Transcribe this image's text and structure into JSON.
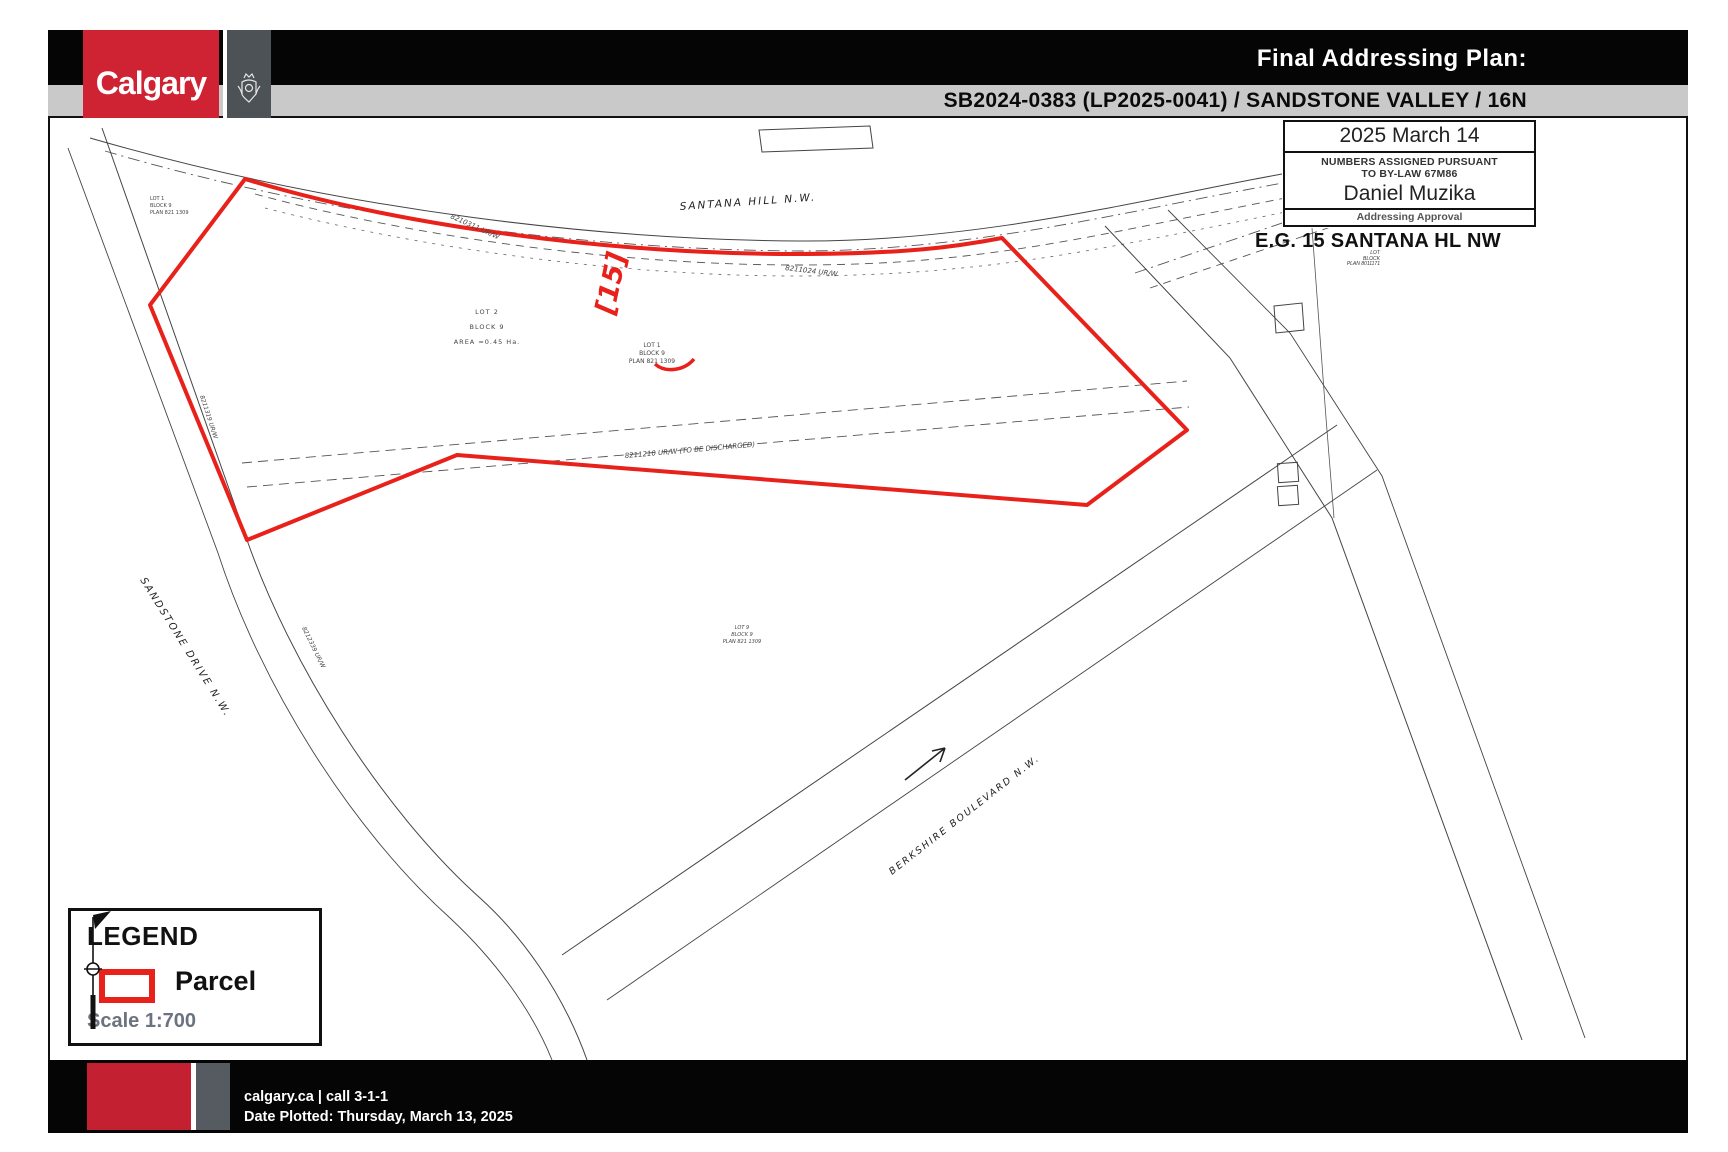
{
  "header": {
    "logo_text": "Calgary",
    "title": "Final Addressing Plan:",
    "subtitle": "SB2024-0383 (LP2025-0041) / SANDSTONE VALLEY / 16N"
  },
  "approval": {
    "date": "2025 March 14",
    "notice_line1": "NUMBERS ASSIGNED PURSUANT",
    "notice_line2": "TO BY-LAW 67M86",
    "approver": "Daniel Muzika",
    "caption": "Addressing Approval"
  },
  "map": {
    "address_note": "E.G. 15 SANTANA HL NW",
    "parcel_tag": "[15]",
    "street_labels": {
      "santana": "SANTANA HILL N.W.",
      "sandstone": "SANDSTONE DRIVE N.W.",
      "berkshire": "BERKSHIRE BOULEVARD N.W."
    },
    "easement_labels": {
      "top_left": "8210311 UR/W",
      "top_right": "8211024 UR/W",
      "middle": "8211210 UR/W (TO BE DISCHARGED)",
      "west_upper": "8211319 UR/W",
      "west_lower": "8212339 UR/W"
    },
    "lot_labels": {
      "northwest_corner": [
        "LOT 1",
        "BLOCK 9",
        "PLAN 821 1309"
      ],
      "lot2": [
        "LOT 2",
        "BLOCK 9",
        "AREA =0.45 Ha."
      ],
      "lot1": [
        "LOT 1",
        "BLOCK 9",
        "PLAN 821 1309"
      ],
      "lot9": [
        "LOT 9",
        "BLOCK 9",
        "PLAN 821 1309"
      ],
      "east": [
        "LOT",
        "BLOCK",
        "PLAN 8011171"
      ]
    }
  },
  "legend": {
    "heading": "LEGEND",
    "parcel_label": "Parcel",
    "scale": "Scale 1:700"
  },
  "footer": {
    "line1": "calgary.ca | call 3-1-1",
    "line2": "Date Plotted: Thursday, March 13, 2025"
  },
  "colors": {
    "calgary_red": "#cf2233",
    "parcel_red": "#e8211a",
    "header_gray": "#c9c9c9",
    "crest_gray": "#4d5257"
  }
}
